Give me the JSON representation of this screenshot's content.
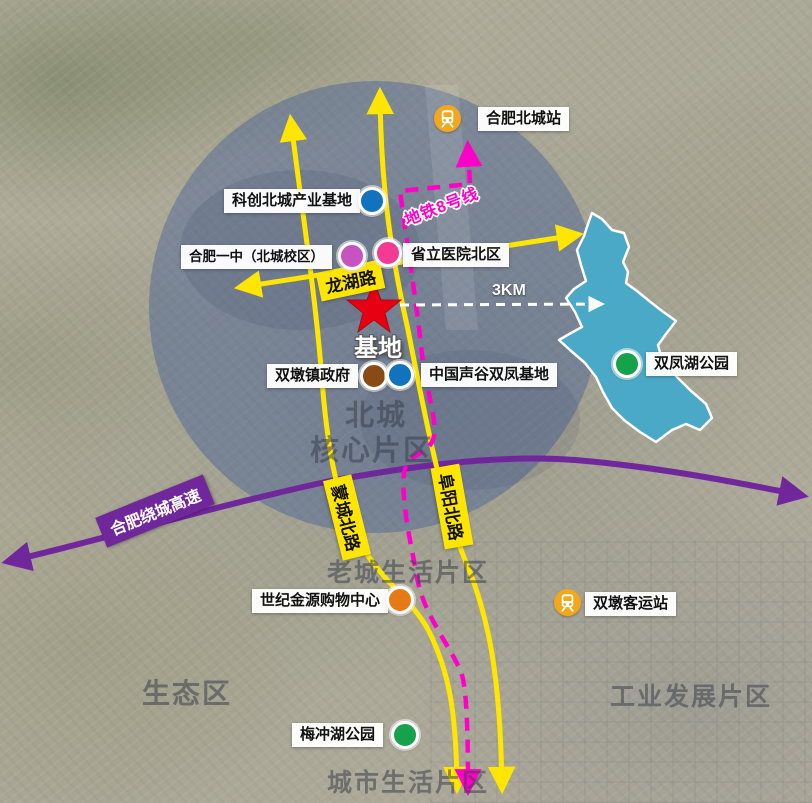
{
  "site": {
    "label": "基地",
    "radius_label": "3KM"
  },
  "metro": {
    "line8_label": "地铁8号线"
  },
  "roads": {
    "longhu": "龙湖路",
    "mengcheng": "蒙城北路",
    "fuyang": "阜阳北路",
    "ring_expressway": "合肥绕城高速"
  },
  "stations": {
    "north_city": "合肥北城站",
    "shuangdun": "双墩客运站"
  },
  "pois": [
    {
      "label": "科创北城产业基地",
      "marker": "blue"
    },
    {
      "label": "合肥一中（北城校区）",
      "marker": "violet"
    },
    {
      "label": "省立医院北区",
      "marker": "pink"
    },
    {
      "label": "双墩镇政府",
      "marker": "brown"
    },
    {
      "label": "中国声谷双凤基地",
      "marker": "blue"
    },
    {
      "label": "双凤湖公园",
      "marker": "green"
    },
    {
      "label": "世纪金源购物中心",
      "marker": "orange"
    },
    {
      "label": "梅冲湖公园",
      "marker": "green"
    }
  ],
  "districts": {
    "core_line1": "北城",
    "core_line2": "核心片区",
    "old_town": "老城生活片区",
    "eco": "生态区",
    "industrial": "工业发展片区",
    "city_life": "城市生活片区"
  },
  "colors": {
    "road_yellow": "#ffe600",
    "expressway_purple": "#71279c",
    "metro_magenta": "#ff00c8",
    "lake_teal": "#4aa9c6",
    "site_star_red": "#e60012",
    "core_circle_fill": "rgba(62,90,152,0.42)",
    "marker_blue": "#1173bd",
    "marker_violet": "#c653c0",
    "marker_pink": "#f43a92",
    "marker_brown": "#8a4a15",
    "marker_green": "#16a24b",
    "marker_orange": "#e57a17",
    "station_icon_yellow": "#f2a81d"
  }
}
